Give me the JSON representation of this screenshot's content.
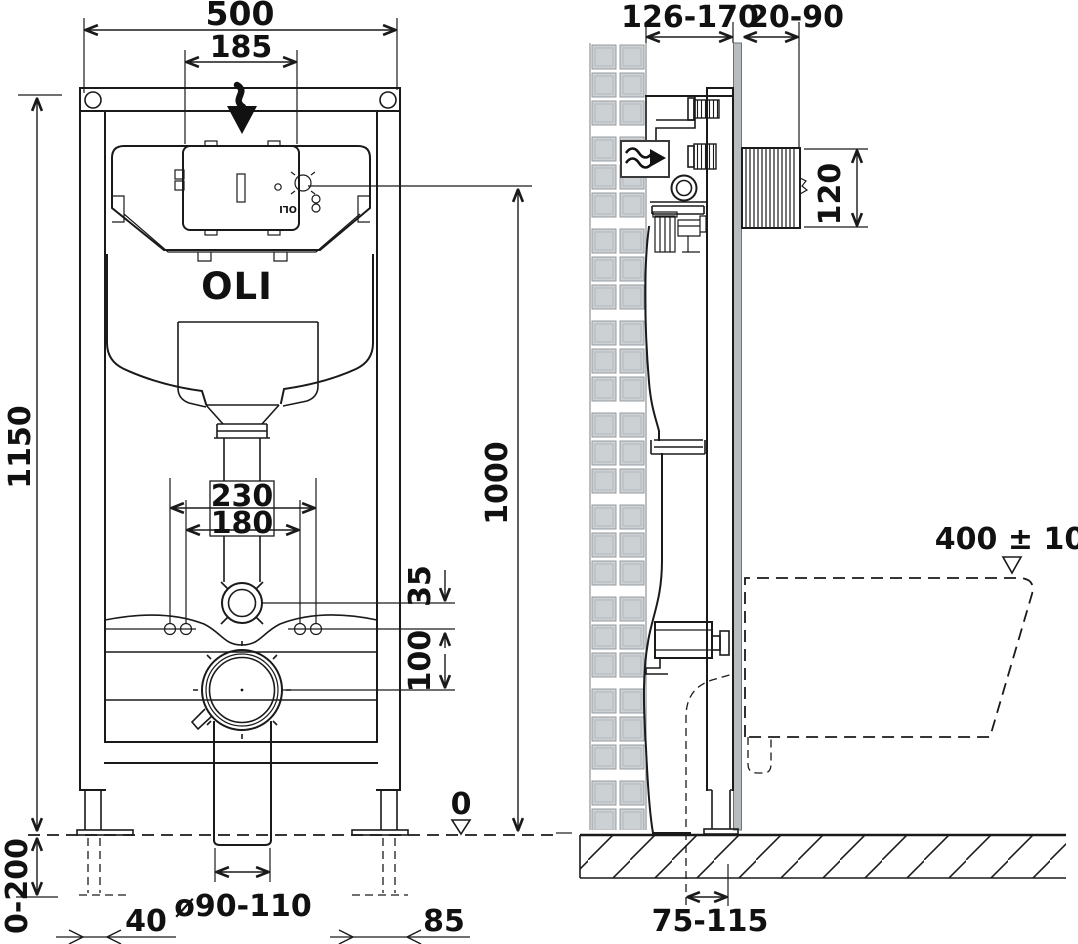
{
  "brand": {
    "logo": "OLI",
    "plate_logo": "OLI"
  },
  "front_view": {
    "dims": {
      "total_width": "500",
      "plate_cutout_width": "185",
      "frame_height": "1150",
      "leg_adjustment": "0-200",
      "fixing_spacing_outer": "230",
      "fixing_spacing_inner": "180",
      "flush_pipe_offset": "35",
      "drain_offset": "100",
      "axis_height": "1000",
      "floor_level": "0",
      "drain_diameter": "ø90-110",
      "left_leg_offset": "40",
      "right_leg_offset": "85"
    }
  },
  "side_view": {
    "dims": {
      "frame_depth": "126-170",
      "plate_depth": "20-90",
      "plate_height": "120",
      "bowl_rim_height": "400 ± 10",
      "drain_wall_distance": "75-115"
    }
  }
}
